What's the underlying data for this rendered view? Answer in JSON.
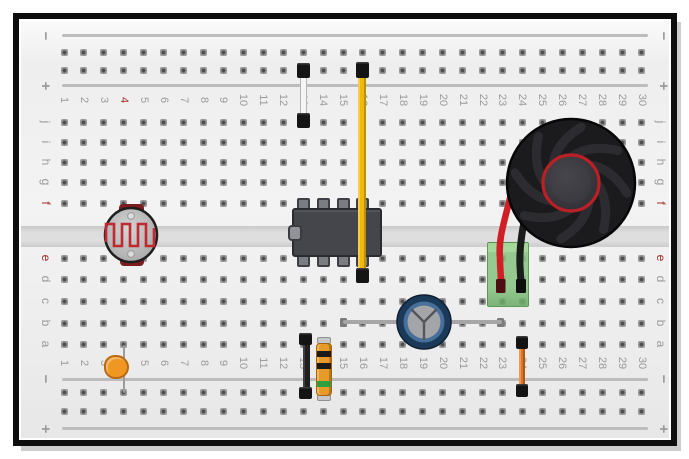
{
  "board": {
    "column_numbers": [
      "1",
      "2",
      "3",
      "4",
      "5",
      "6",
      "7",
      "8",
      "9",
      "10",
      "11",
      "12",
      "13",
      "14",
      "15",
      "16",
      "17",
      "18",
      "19",
      "20",
      "21",
      "22",
      "23",
      "24",
      "25",
      "26",
      "27",
      "28",
      "29",
      "30"
    ],
    "row_letters_top": [
      "j",
      "i",
      "h",
      "g",
      "f"
    ],
    "row_letters_bottom": [
      "e",
      "d",
      "c",
      "b",
      "a"
    ],
    "rail_minus": "−",
    "rail_plus": "+",
    "highlight_number": "4",
    "highlight_letters": [
      "e",
      "f"
    ],
    "label_color": "#9a9a9a",
    "highlight_color": "#9c2f28"
  },
  "components": {
    "photoresistor": {
      "body_color": "#bdbdbd",
      "trace_color": "#c22830",
      "position": "columns 4-5 straddling center channel, rows f to e"
    },
    "ic": {
      "body_color": "#45464c",
      "pins": 8,
      "position": "columns 13-16, rows f and e"
    },
    "white_jumper": {
      "color": "#f5f5f3",
      "position": "column 13, + rail to row j"
    },
    "yellow_wire": {
      "color": "#f2b90d",
      "position": "column 16, + rail to row d, passes over IC"
    },
    "speaker": {
      "body_color": "#1b1b1d",
      "ring_color": "#bb2026",
      "position": "columns 24-29, rows f-j"
    },
    "red_wire": {
      "color": "#d01f26",
      "position": "speaker to column 23"
    },
    "black_wire": {
      "color": "#1b1b1b",
      "position": "speaker to column 24"
    },
    "terminal_block": {
      "color": "#7ab87a",
      "position": "columns 22-24, rows e-c"
    },
    "electrolytic_capacitor": {
      "ring_color": "#1b3a5a",
      "inner_color": "#466f99",
      "top_color": "#a4a5a9",
      "lead_color": "#a6a6a6",
      "position": "body at column 19 row b, leads from column 15 to column 23"
    },
    "resistor": {
      "body_color": "#e89a28",
      "band_colors": [
        "#1a1a1a",
        "#1a1a1a",
        "#2f9e3f"
      ],
      "bands": [
        "black",
        "black",
        "green"
      ],
      "position": "column 14, row a to − rail"
    },
    "black_jumper": {
      "color": "#1f1f1f",
      "position": "column 13, row a to − rail"
    },
    "disc_capacitor": {
      "color": "#ef9722",
      "position": "column 4, row a to − rail"
    },
    "orange_jumper": {
      "color": "#e2731c",
      "position": "column 24, row a to − rail"
    }
  }
}
